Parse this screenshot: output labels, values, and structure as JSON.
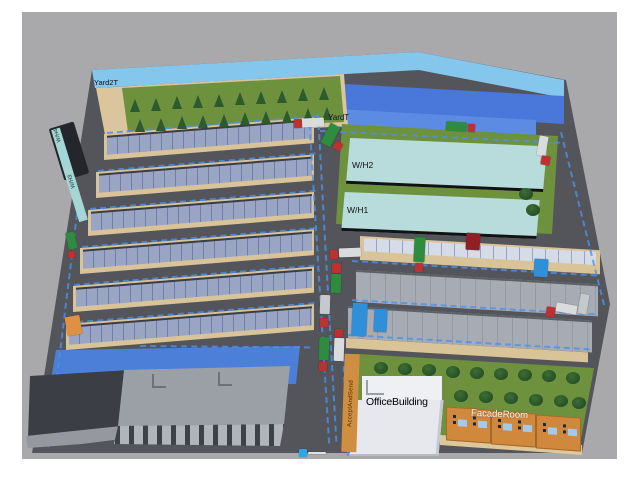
{
  "labels": {
    "yard2t": "Yard2T",
    "yardt": "YardT",
    "wh2": "W/H2",
    "wh1": "W/H1",
    "sign_wh4": "W/H4",
    "sign_wh3": "W/H3",
    "accept_and_send": "AcceptAndSend",
    "office_building": "OfficeBuilding",
    "facade_room": "FacadeRoom"
  },
  "colors": {
    "canvas_gray": "#a9a9ab",
    "ground_road": "#53555b",
    "water_light": "#85c6ec",
    "water_royal": "#4a77da",
    "yardt_blue": "#5b8be2",
    "sand": "#dbc59d",
    "grass": "#6e913e",
    "rack_panel": "#9aa5c3",
    "warehouse_roof": "#b8dbdb",
    "path_blue": "#4b91e8",
    "truck_red": "#bf3131",
    "truck_green": "#2e8c3e",
    "container_blue": "#2f90d9",
    "room_orange": "#d0883c"
  },
  "vehicles": [
    {
      "name": "truck-cab-red",
      "x": 272,
      "y": 107,
      "w": 8,
      "h": 9,
      "rot": -3,
      "color": "#bf3131"
    },
    {
      "name": "truck-trailer-white",
      "x": 280,
      "y": 106,
      "w": 22,
      "h": 9,
      "rot": -3,
      "color": "#d9dbdd"
    },
    {
      "name": "truck-trailer-green",
      "x": 303,
      "y": 112,
      "w": 11,
      "h": 22,
      "rot": 28,
      "color": "#2e8c3e"
    },
    {
      "name": "truck-cab-red",
      "x": 312,
      "y": 130,
      "w": 8,
      "h": 8,
      "rot": 28,
      "color": "#bf3131"
    },
    {
      "name": "truck-trailer-green",
      "x": 424,
      "y": 110,
      "w": 21,
      "h": 9,
      "rot": 4,
      "color": "#2e8c3e"
    },
    {
      "name": "truck-cab-red",
      "x": 446,
      "y": 112,
      "w": 7,
      "h": 8,
      "rot": 4,
      "color": "#bf3131"
    },
    {
      "name": "truck-trailer-white",
      "x": 516,
      "y": 124,
      "w": 9,
      "h": 20,
      "rot": 10,
      "color": "#d9dbdd"
    },
    {
      "name": "truck-cab-red",
      "x": 519,
      "y": 144,
      "w": 9,
      "h": 9,
      "rot": 10,
      "color": "#bf3131"
    },
    {
      "name": "truck-trailer-green",
      "x": 45,
      "y": 220,
      "w": 9,
      "h": 17,
      "rot": -14,
      "color": "#2e8c3e"
    },
    {
      "name": "truck-cab-red",
      "x": 46,
      "y": 239,
      "w": 7,
      "h": 7,
      "rot": -14,
      "color": "#bf3131"
    },
    {
      "name": "truck-cab-red",
      "x": 308,
      "y": 238,
      "w": 8,
      "h": 9,
      "rot": -2,
      "color": "#bf3131"
    },
    {
      "name": "truck-trailer-white",
      "x": 317,
      "y": 236,
      "w": 22,
      "h": 9,
      "rot": -2,
      "color": "#d9dbdd"
    },
    {
      "name": "truck-cab-red",
      "x": 310,
      "y": 251,
      "w": 9,
      "h": 10,
      "rot": 2,
      "color": "#bf3131"
    },
    {
      "name": "truck-trailer-green",
      "x": 309,
      "y": 262,
      "w": 10,
      "h": 19,
      "rot": 2,
      "color": "#2e8c3e"
    },
    {
      "name": "truck-trailer-gray",
      "x": 298,
      "y": 283,
      "w": 10,
      "h": 19,
      "rot": 2,
      "color": "#c6c9cc"
    },
    {
      "name": "truck-cab-red",
      "x": 298,
      "y": 306,
      "w": 8,
      "h": 9,
      "rot": 2,
      "color": "#bf3131"
    },
    {
      "name": "truck-trailer-green",
      "x": 297,
      "y": 325,
      "w": 10,
      "h": 23,
      "rot": 2,
      "color": "#2e8c3e"
    },
    {
      "name": "truck-cab-red",
      "x": 297,
      "y": 350,
      "w": 8,
      "h": 9,
      "rot": 2,
      "color": "#bf3131"
    },
    {
      "name": "truck-cab-red",
      "x": 313,
      "y": 317,
      "w": 8,
      "h": 8,
      "rot": 2,
      "color": "#bf3131"
    },
    {
      "name": "truck-trailer-white",
      "x": 312,
      "y": 326,
      "w": 10,
      "h": 23,
      "rot": 2,
      "color": "#d9dbdd"
    },
    {
      "name": "truck-trailer-green",
      "x": 392,
      "y": 225,
      "w": 11,
      "h": 25,
      "rot": 3,
      "color": "#2e8c3e"
    },
    {
      "name": "truck-cab-red",
      "x": 393,
      "y": 251,
      "w": 8,
      "h": 9,
      "rot": 3,
      "color": "#bf3131"
    },
    {
      "name": "container-darkred",
      "x": 444,
      "y": 221,
      "w": 14,
      "h": 17,
      "rot": 3,
      "color": "#8e2026"
    },
    {
      "name": "container-blue",
      "x": 512,
      "y": 247,
      "w": 14,
      "h": 18,
      "rot": 3,
      "color": "#2f90d9"
    },
    {
      "name": "container-blue",
      "x": 330,
      "y": 291,
      "w": 15,
      "h": 33,
      "rot": 3,
      "color": "#2f90d9"
    },
    {
      "name": "container-blue",
      "x": 352,
      "y": 297,
      "w": 13,
      "h": 23,
      "rot": 3,
      "color": "#2f90d9"
    },
    {
      "name": "truck-cab-red",
      "x": 524,
      "y": 295,
      "w": 9,
      "h": 10,
      "rot": 10,
      "color": "#bf3131"
    },
    {
      "name": "truck-trailer-white",
      "x": 534,
      "y": 292,
      "w": 21,
      "h": 9,
      "rot": 10,
      "color": "#d9dbdd"
    },
    {
      "name": "truck-trailer-gray",
      "x": 557,
      "y": 282,
      "w": 9,
      "h": 20,
      "rot": 10,
      "color": "#c6c9cc"
    },
    {
      "name": "container-orange",
      "x": 44,
      "y": 304,
      "w": 15,
      "h": 19,
      "rot": -10,
      "color": "#df9143"
    },
    {
      "name": "marker-blue-cube",
      "x": 277,
      "y": 437,
      "w": 8,
      "h": 8,
      "rot": 0,
      "color": "#2aa7e8"
    },
    {
      "name": "marker-line-white",
      "x": 286,
      "y": 440,
      "w": 18,
      "h": 2,
      "rot": 0,
      "color": "#dfe2e5"
    }
  ],
  "trees_cone": [
    [
      108,
      87
    ],
    [
      129,
      86
    ],
    [
      150,
      84
    ],
    [
      171,
      83
    ],
    [
      192,
      82
    ],
    [
      213,
      80
    ],
    [
      234,
      79
    ],
    [
      255,
      78
    ],
    [
      276,
      76
    ],
    [
      297,
      75
    ],
    [
      113,
      107
    ],
    [
      134,
      106
    ],
    [
      155,
      104
    ],
    [
      176,
      103
    ],
    [
      197,
      102
    ],
    [
      218,
      100
    ],
    [
      239,
      99
    ],
    [
      260,
      98
    ],
    [
      281,
      96
    ],
    [
      300,
      95
    ]
  ],
  "trees_round": [
    [
      352,
      350
    ],
    [
      376,
      351
    ],
    [
      400,
      352
    ],
    [
      424,
      354
    ],
    [
      448,
      355
    ],
    [
      472,
      356
    ],
    [
      496,
      357
    ],
    [
      520,
      358
    ],
    [
      544,
      360
    ],
    [
      432,
      378
    ],
    [
      457,
      379
    ],
    [
      482,
      380
    ],
    [
      507,
      382
    ],
    [
      532,
      383
    ],
    [
      550,
      385
    ],
    [
      497,
      176
    ],
    [
      504,
      192
    ]
  ],
  "paths": [
    {
      "x": 85,
      "y": 120,
      "len": 212,
      "rot": -4.6
    },
    {
      "x": 76,
      "y": 158,
      "len": 218,
      "rot": -4.6
    },
    {
      "x": 68,
      "y": 196,
      "len": 226,
      "rot": -4.6
    },
    {
      "x": 60,
      "y": 234,
      "len": 234,
      "rot": -4.6
    },
    {
      "x": 52,
      "y": 272,
      "len": 241,
      "rot": -4.6
    },
    {
      "x": 45,
      "y": 310,
      "len": 248,
      "rot": -4.6
    },
    {
      "x": 298,
      "y": 118,
      "len": 240,
      "rot": 2.8
    },
    {
      "x": 330,
      "y": 248,
      "len": 245,
      "rot": 3.4
    },
    {
      "x": 330,
      "y": 287,
      "len": 243,
      "rot": 3.4
    },
    {
      "x": 326,
      "y": 322,
      "len": 242,
      "rot": 3.4
    },
    {
      "x": 288,
      "y": 102,
      "len": 330,
      "rot": 86.5
    },
    {
      "x": 297,
      "y": 102,
      "len": 328,
      "rot": 86.8
    },
    {
      "x": 540,
      "y": 120,
      "len": 178,
      "rot": 76
    },
    {
      "x": 56,
      "y": 202,
      "len": 235,
      "rot": 97
    },
    {
      "x": 118,
      "y": 333,
      "len": 170,
      "rot": 0.5
    },
    {
      "x": 322,
      "y": 344,
      "len": 100,
      "rot": 87
    }
  ],
  "rooms": [
    {
      "x": 424,
      "y": 396
    },
    {
      "x": 469,
      "y": 400
    },
    {
      "x": 514,
      "y": 404
    }
  ]
}
